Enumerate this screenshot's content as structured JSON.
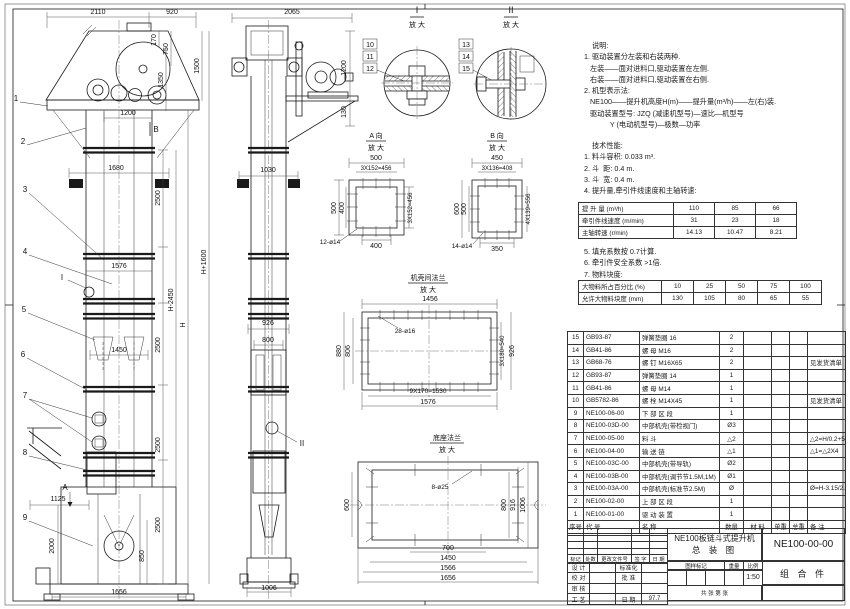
{
  "notes": {
    "lines": [
      "    说明:",
      "1. 驱动装置分左装和右装两种.",
      "   左装——面对进料口,驱动装置在左侧.",
      "   右装——面对进料口,驱动装置在右侧.",
      "2. 机型表示法:",
      "   NE100——提升机高度H(m)——提升量(m³/h)——左(右)装.",
      "   驱动装置型号: JZQ (减速机型号)—速比—机型号",
      "             Y (电动机型号)—极数—功率"
    ]
  },
  "tech": {
    "lines_before": [
      "    技术性能:",
      "1. 料斗容积: 0.033 m³.",
      "2. 斗  距: 0.4 m.",
      "3. 斗  宽: 0.4 m.",
      "4. 提升量,牵引件线速度和主轴转速:"
    ],
    "lines_after": [
      "5. 填充系数按 0.7计算.",
      "6. 牵引件安全系数 >1倍.",
      "7. 物料块度:"
    ],
    "perf_rows": [
      [
        "提 升 量  (m³/h)",
        "110",
        "85",
        "66"
      ],
      [
        "牵引件线速度 (m/min)",
        "31",
        "23",
        "18"
      ],
      [
        "主轴转速 (r/min)",
        "14.13",
        "10.47",
        "8.21"
      ]
    ],
    "lump_rows": [
      [
        "大物料所占百分比 (%)",
        "10",
        "25",
        "50",
        "75",
        "100"
      ],
      [
        "允许大物料块度 (mm)",
        "130",
        "105",
        "80",
        "65",
        "55"
      ]
    ]
  },
  "bom": {
    "rows": [
      [
        "15",
        "GB93-87",
        "弹簧垫圈  16",
        "2",
        "",
        "",
        "",
        ""
      ],
      [
        "14",
        "GB41-86",
        "螺  母  M16",
        "2",
        "",
        "",
        "",
        ""
      ],
      [
        "13",
        "GB68-76",
        "螺  钉  M16X65",
        "2",
        "",
        "",
        "",
        "见发货清单"
      ],
      [
        "12",
        "GB93-87",
        "弹簧垫圈  14",
        "1",
        "",
        "",
        "",
        ""
      ],
      [
        "11",
        "GB41-86",
        "螺  母  M14",
        "1",
        "",
        "",
        "",
        ""
      ],
      [
        "10",
        "GB5782-86",
        "螺  栓  M14X45",
        "1",
        "",
        "",
        "",
        "见发货清单"
      ],
      [
        "9",
        "NE100-06-00",
        "下 部 区 段",
        "1",
        "",
        "",
        "",
        ""
      ],
      [
        "8",
        "NE100-03D-00",
        "中部机壳(带检视门)",
        "Ø3",
        "",
        "",
        "",
        ""
      ],
      [
        "7",
        "NE100-05-00",
        "料  斗",
        "△2",
        "",
        "",
        "",
        "△2=H/0.2+5.75"
      ],
      [
        "6",
        "NE100-04-00",
        "输 送 链",
        "△1",
        "",
        "",
        "",
        "△1=△2X4"
      ],
      [
        "5",
        "NE100-03C-00",
        "中部机壳(带导轨)",
        "Ø2",
        "",
        "",
        "",
        ""
      ],
      [
        "4",
        "NE100-03B-00",
        "中部机壳(调节节1.5M,1M)",
        "Ø1",
        "",
        "",
        "",
        ""
      ],
      [
        "3",
        "NE100-03A-00",
        "中部机壳(标准节2.5M)",
        "Ø",
        "",
        "",
        "",
        "Ø=H-3.15/2.5"
      ],
      [
        "2",
        "NE100-02-00",
        "上 部 区 段",
        "1",
        "",
        "",
        "",
        ""
      ],
      [
        "1",
        "NE100-01-00",
        "驱 动 装 置",
        "1",
        "",
        "",
        "",
        ""
      ]
    ],
    "footer_rows": [
      [
        "序号",
        "代  号",
        "名  称",
        "数量",
        "材  料",
        "单重",
        "总重",
        "备  注"
      ]
    ]
  },
  "title_block": {
    "revision_rows": [
      [
        "",
        "",
        "",
        "",
        ""
      ],
      [
        "",
        "",
        "",
        "",
        ""
      ],
      [
        "",
        "",
        "",
        "",
        ""
      ],
      [
        "",
        "",
        "",
        "",
        ""
      ],
      [
        "标记",
        "处数",
        "更改文件号",
        "签 字",
        "日 期"
      ]
    ],
    "sign_rows": [
      [
        "设 计",
        "",
        "标准化",
        ""
      ],
      [
        "校 对",
        "",
        "批 准",
        ""
      ],
      [
        "审 核",
        "",
        "",
        ""
      ],
      [
        "工 艺",
        "",
        "日 期",
        "97.7"
      ]
    ],
    "title_line1": "NE100板链斗式提升机",
    "title_line2": "总  装  图",
    "stamp_rows": [
      [
        "图样标记",
        "重量",
        "比例"
      ]
    ],
    "stamp_value_rows": [
      [
        "",
        "",
        "",
        "",
        "1:50"
      ]
    ],
    "sheet_note": "共  张   第  张",
    "drawing_no": "NE100-00-00",
    "part_type": "组 合 件"
  },
  "drawing": {
    "labels": [
      {
        "t": "2110",
        "x": 98,
        "y": 14
      },
      {
        "t": "920",
        "x": 172,
        "y": 14
      },
      {
        "t": "170",
        "x": 156,
        "y": 40,
        "r": -90
      },
      {
        "t": "750",
        "x": 168,
        "y": 49,
        "r": -90
      },
      {
        "t": "1350",
        "x": 163,
        "y": 80,
        "r": -90
      },
      {
        "t": "1500",
        "x": 199,
        "y": 66,
        "r": -90
      },
      {
        "t": "1200",
        "x": 128,
        "y": 115
      },
      {
        "t": "1680",
        "x": 116,
        "y": 170
      },
      {
        "t": "1576",
        "x": 119,
        "y": 268
      },
      {
        "t": "1450",
        "x": 119,
        "y": 352
      },
      {
        "t": "2500",
        "x": 160,
        "y": 198,
        "r": -90
      },
      {
        "t": "2500",
        "x": 160,
        "y": 345,
        "r": -90
      },
      {
        "t": "2500",
        "x": 160,
        "y": 445,
        "r": -90
      },
      {
        "t": "2500",
        "x": 160,
        "y": 525,
        "r": -90
      },
      {
        "t": "H-2450",
        "x": 173,
        "y": 300,
        "r": -90
      },
      {
        "t": "H",
        "x": 185,
        "y": 325,
        "r": -90
      },
      {
        "t": "H+1600",
        "x": 206,
        "y": 262,
        "r": -90
      },
      {
        "t": "1125",
        "x": 58,
        "y": 501
      },
      {
        "t": "2000",
        "x": 54,
        "y": 546,
        "r": -90
      },
      {
        "t": "850",
        "x": 144,
        "y": 556,
        "r": -90
      },
      {
        "t": "1656",
        "x": 119,
        "y": 594
      },
      {
        "t": "1",
        "x": 16,
        "y": 101,
        "s": 8,
        "n": "part-balloon-1"
      },
      {
        "t": "2",
        "x": 23,
        "y": 144,
        "s": 8,
        "n": "part-balloon-2"
      },
      {
        "t": "3",
        "x": 25,
        "y": 192,
        "s": 8,
        "n": "part-balloon-3"
      },
      {
        "t": "4",
        "x": 25,
        "y": 254,
        "s": 8,
        "n": "part-balloon-4"
      },
      {
        "t": "5",
        "x": 24,
        "y": 312,
        "s": 8,
        "n": "part-balloon-5"
      },
      {
        "t": "6",
        "x": 23,
        "y": 357,
        "s": 8,
        "n": "part-balloon-6"
      },
      {
        "t": "7",
        "x": 25,
        "y": 398,
        "s": 8,
        "n": "part-balloon-7"
      },
      {
        "t": "8",
        "x": 25,
        "y": 455,
        "s": 8,
        "n": "part-balloon-8"
      },
      {
        "t": "9",
        "x": 25,
        "y": 520,
        "s": 8,
        "n": "part-balloon-9"
      },
      {
        "t": "I",
        "x": 62,
        "y": 280,
        "s": 8,
        "n": "detail-mark-I"
      },
      {
        "t": "A",
        "x": 65,
        "y": 490,
        "s": 8,
        "n": "view-mark-A"
      },
      {
        "t": "B",
        "x": 156,
        "y": 132,
        "s": 8,
        "n": "view-mark-B"
      },
      {
        "t": "2065",
        "x": 292,
        "y": 14
      },
      {
        "t": "1200",
        "x": 346,
        "y": 68,
        "r": -90
      },
      {
        "t": "130",
        "x": 346,
        "y": 112,
        "r": -90
      },
      {
        "t": "1030",
        "x": 268,
        "y": 172
      },
      {
        "t": "926",
        "x": 268,
        "y": 325
      },
      {
        "t": "800",
        "x": 268,
        "y": 342
      },
      {
        "t": "1006",
        "x": 269,
        "y": 590
      },
      {
        "t": "II",
        "x": 302,
        "y": 446,
        "s": 8,
        "n": "detail-mark-II"
      },
      {
        "t": "10",
        "x": 370,
        "y": 47,
        "n": "part-balloon-10"
      },
      {
        "t": "11",
        "x": 370,
        "y": 59,
        "n": "part-balloon-11"
      },
      {
        "t": "12",
        "x": 370,
        "y": 71,
        "n": "part-balloon-12"
      },
      {
        "t": "13",
        "x": 466,
        "y": 47,
        "n": "part-balloon-13"
      },
      {
        "t": "14",
        "x": 466,
        "y": 59,
        "n": "part-balloon-14"
      },
      {
        "t": "15",
        "x": 466,
        "y": 71,
        "n": "part-balloon-15"
      },
      {
        "t": "I",
        "x": 417,
        "y": 13,
        "s": 9,
        "n": "detail-title-I"
      },
      {
        "t": "放 大",
        "x": 417,
        "y": 27,
        "n": "detail-title-I-sub"
      },
      {
        "t": "II",
        "x": 511,
        "y": 13,
        "s": 9,
        "n": "detail-title-II"
      },
      {
        "t": "放 大",
        "x": 511,
        "y": 27,
        "n": "detail-title-II-sub"
      },
      {
        "t": "A 向",
        "x": 376,
        "y": 138,
        "n": "view-title-A"
      },
      {
        "t": "放 大",
        "x": 376,
        "y": 150,
        "n": "view-title-A-sub"
      },
      {
        "t": "500",
        "x": 376,
        "y": 160
      },
      {
        "t": "3X152=456",
        "x": 376,
        "y": 170,
        "s": 6
      },
      {
        "t": "500",
        "x": 336,
        "y": 208,
        "r": -90
      },
      {
        "t": "400",
        "x": 344,
        "y": 208,
        "r": -90
      },
      {
        "t": "3X152=456",
        "x": 412,
        "y": 208,
        "r": -90,
        "s": 6
      },
      {
        "t": "400",
        "x": 376,
        "y": 248
      },
      {
        "t": "12-ø14",
        "x": 330,
        "y": 244,
        "s": 6.5
      },
      {
        "t": "B 向",
        "x": 497,
        "y": 138,
        "n": "view-title-B"
      },
      {
        "t": "放 大",
        "x": 497,
        "y": 150,
        "n": "view-title-B-sub"
      },
      {
        "t": "450",
        "x": 497,
        "y": 160
      },
      {
        "t": "3X136=408",
        "x": 497,
        "y": 170,
        "s": 6
      },
      {
        "t": "600",
        "x": 459,
        "y": 209,
        "r": -90
      },
      {
        "t": "500",
        "x": 466,
        "y": 209,
        "r": -90
      },
      {
        "t": "4X139=556",
        "x": 530,
        "y": 209,
        "r": -90,
        "s": 6
      },
      {
        "t": "14-ø14",
        "x": 462,
        "y": 248,
        "s": 6.5
      },
      {
        "t": "350",
        "x": 497,
        "y": 251
      },
      {
        "t": "机壳间法兰",
        "x": 428,
        "y": 280,
        "n": "view-title-casing-flange"
      },
      {
        "t": "放 大",
        "x": 428,
        "y": 292,
        "n": "view-title-casing-flange-sub"
      },
      {
        "t": "1456",
        "x": 430,
        "y": 301
      },
      {
        "t": "28-ø16",
        "x": 405,
        "y": 333,
        "s": 6.5
      },
      {
        "t": "880",
        "x": 341,
        "y": 351,
        "r": -90
      },
      {
        "t": "806",
        "x": 350,
        "y": 351,
        "r": -90
      },
      {
        "t": "3X180=540",
        "x": 504,
        "y": 351,
        "r": -90,
        "s": 6
      },
      {
        "t": "926",
        "x": 514,
        "y": 351,
        "r": -90
      },
      {
        "t": "9X170=1530",
        "x": 428,
        "y": 393,
        "s": 6.5
      },
      {
        "t": "1576",
        "x": 428,
        "y": 404
      },
      {
        "t": "底座法兰",
        "x": 447,
        "y": 440,
        "n": "view-title-base-flange"
      },
      {
        "t": "放 大",
        "x": 447,
        "y": 452,
        "n": "view-title-base-flange-sub"
      },
      {
        "t": "8-ø25",
        "x": 440,
        "y": 489,
        "s": 6.5
      },
      {
        "t": "600",
        "x": 349,
        "y": 505,
        "r": -90
      },
      {
        "t": "800",
        "x": 506,
        "y": 505,
        "r": -90
      },
      {
        "t": "916",
        "x": 515,
        "y": 505,
        "r": -90
      },
      {
        "t": "1006",
        "x": 525,
        "y": 505,
        "r": -90
      },
      {
        "t": "700",
        "x": 448,
        "y": 550
      },
      {
        "t": "1450",
        "x": 448,
        "y": 560
      },
      {
        "t": "1566",
        "x": 448,
        "y": 570
      },
      {
        "t": "1656",
        "x": 448,
        "y": 580
      }
    ]
  }
}
